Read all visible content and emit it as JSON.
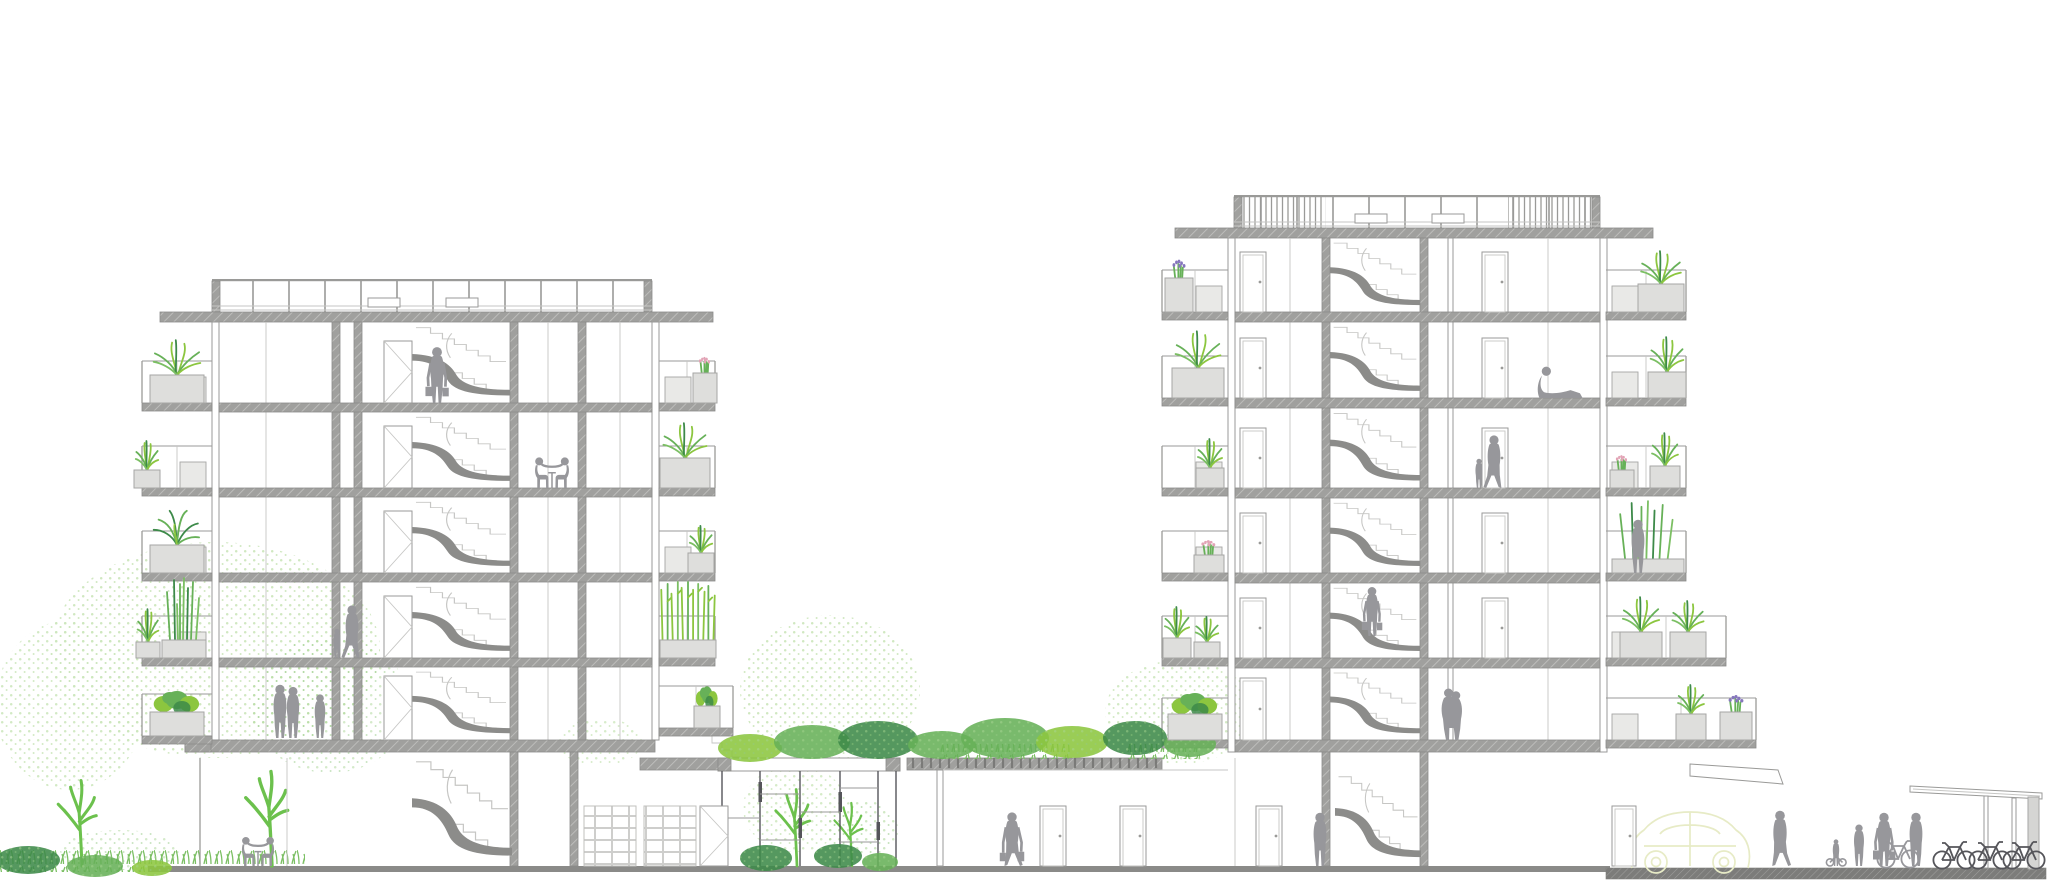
{
  "meta": {
    "drawing_type": "architectural cross-section",
    "subject": "two residential apartment blocks linked by a green-roofed podium with glazed atrium",
    "text_labels": []
  },
  "colors": {
    "background": "#ffffff",
    "slab": "#a0a09e",
    "slab_edge": "#8b8b89",
    "slab_solid": "#8c8c8a",
    "line": "#9a9a98",
    "line_light": "#c6c6c4",
    "glass": "#55555a",
    "people": "#97979b",
    "planter_fill": "#dededc",
    "planter_edge": "#a6a6a4",
    "screen_fill": "#e9e9e7",
    "green_bright": "#8cc63f",
    "green_mid": "#67b158",
    "green_dark": "#3d8a49",
    "green_pale": "#cde7bd",
    "green_line": "#6cc14d",
    "grass_stroke": "#7bbf63",
    "flower_pink": "#e2a4b6",
    "flower_purple": "#8677bd",
    "car_outline": "#e7ebc6",
    "ground": "#8a8a88",
    "sidewalk": "#7c7c7a",
    "trellis": "#70706e"
  },
  "scene": {
    "left_building": {
      "residential_floors": 5,
      "ground_floor": true,
      "roof_railing": true,
      "stair_core": true
    },
    "right_building": {
      "residential_floors": 6,
      "ground_floor": true,
      "roof_railing": true,
      "stair_core": true
    },
    "podium": {
      "glazed_atrium": true,
      "green_roof": true,
      "pergola_deck": true
    },
    "balconies": [
      {
        "x1": 142,
        "x2": 212,
        "y": 403,
        "scr": true
      },
      {
        "x1": 142,
        "x2": 212,
        "y": 488,
        "scr": true
      },
      {
        "x1": 142,
        "x2": 212,
        "y": 573,
        "scr": true
      },
      {
        "x1": 142,
        "x2": 212,
        "y": 658,
        "scr": true
      },
      {
        "x1": 142,
        "x2": 212,
        "y": 736,
        "scr": false
      },
      {
        "x1": 715,
        "x2": 659,
        "y": 403,
        "scr": true
      },
      {
        "x1": 715,
        "x2": 659,
        "y": 488,
        "scr": true
      },
      {
        "x1": 715,
        "x2": 659,
        "y": 573,
        "scr": true
      },
      {
        "x1": 715,
        "x2": 659,
        "y": 658,
        "scr": false
      },
      {
        "x1": 733,
        "x2": 659,
        "y": 728,
        "scr": false
      },
      {
        "x1": 1162,
        "x2": 1228,
        "y": 312,
        "scr": true
      },
      {
        "x1": 1162,
        "x2": 1228,
        "y": 398,
        "scr": true
      },
      {
        "x1": 1162,
        "x2": 1228,
        "y": 488,
        "scr": true
      },
      {
        "x1": 1162,
        "x2": 1228,
        "y": 573,
        "scr": true
      },
      {
        "x1": 1162,
        "x2": 1228,
        "y": 658,
        "scr": false
      },
      {
        "x1": 1162,
        "x2": 1228,
        "y": 740,
        "scr": false
      },
      {
        "x1": 1686,
        "x2": 1606,
        "y": 312,
        "scr": true
      },
      {
        "x1": 1686,
        "x2": 1606,
        "y": 398,
        "scr": true
      },
      {
        "x1": 1686,
        "x2": 1606,
        "y": 488,
        "scr": true
      },
      {
        "x1": 1686,
        "x2": 1606,
        "y": 573,
        "scr": false
      },
      {
        "x1": 1726,
        "x2": 1606,
        "y": 658,
        "scr": true
      },
      {
        "x1": 1756,
        "x2": 1606,
        "y": 740,
        "scr": true
      }
    ],
    "planters": [
      {
        "x": 150,
        "y": 403,
        "w": 54,
        "h": 28,
        "plant": "grass",
        "ph": 36
      },
      {
        "x": 134,
        "y": 488,
        "w": 26,
        "h": 18,
        "plant": "grass",
        "ph": 30
      },
      {
        "x": 150,
        "y": 573,
        "w": 54,
        "h": 28,
        "plant": "fern",
        "ph": 38
      },
      {
        "x": 136,
        "y": 658,
        "w": 24,
        "h": 16,
        "plant": "grass",
        "ph": 34
      },
      {
        "x": 162,
        "y": 658,
        "w": 44,
        "h": 18,
        "plant": "reeds",
        "ph": 60
      },
      {
        "x": 150,
        "y": 736,
        "w": 54,
        "h": 24,
        "plant": "shrub",
        "ph": 30
      },
      {
        "x": 693,
        "y": 403,
        "w": 24,
        "h": 30,
        "plant": "fpink",
        "ph": 24
      },
      {
        "x": 660,
        "y": 488,
        "w": 50,
        "h": 30,
        "plant": "grass",
        "ph": 36
      },
      {
        "x": 688,
        "y": 573,
        "w": 26,
        "h": 20,
        "plant": "grass",
        "ph": 28
      },
      {
        "x": 660,
        "y": 658,
        "w": 56,
        "h": 18,
        "plant": "bamboo",
        "ph": 58
      },
      {
        "x": 694,
        "y": 728,
        "w": 26,
        "h": 22,
        "plant": "shrub",
        "ph": 28
      },
      {
        "x": 1165,
        "y": 312,
        "w": 28,
        "h": 34,
        "plant": "fpurple",
        "ph": 26
      },
      {
        "x": 1172,
        "y": 398,
        "w": 52,
        "h": 30,
        "plant": "grass",
        "ph": 38
      },
      {
        "x": 1196,
        "y": 488,
        "w": 28,
        "h": 20,
        "plant": "grass",
        "ph": 30
      },
      {
        "x": 1194,
        "y": 573,
        "w": 30,
        "h": 18,
        "plant": "fpink",
        "ph": 22
      },
      {
        "x": 1163,
        "y": 658,
        "w": 28,
        "h": 20,
        "plant": "grass",
        "ph": 32
      },
      {
        "x": 1194,
        "y": 658,
        "w": 26,
        "h": 16,
        "plant": "grass",
        "ph": 26
      },
      {
        "x": 1168,
        "y": 740,
        "w": 54,
        "h": 26,
        "plant": "shrub",
        "ph": 30
      },
      {
        "x": 1638,
        "y": 312,
        "w": 46,
        "h": 28,
        "plant": "grass",
        "ph": 34
      },
      {
        "x": 1648,
        "y": 398,
        "w": 38,
        "h": 26,
        "plant": "grass",
        "ph": 36
      },
      {
        "x": 1610,
        "y": 488,
        "w": 24,
        "h": 18,
        "plant": "fpink",
        "ph": 22
      },
      {
        "x": 1650,
        "y": 488,
        "w": 30,
        "h": 22,
        "plant": "grass",
        "ph": 34
      },
      {
        "x": 1612,
        "y": 573,
        "w": 72,
        "h": 14,
        "plant": "reeds",
        "ph": 56
      },
      {
        "x": 1620,
        "y": 658,
        "w": 42,
        "h": 26,
        "plant": "grass",
        "ph": 36
      },
      {
        "x": 1670,
        "y": 658,
        "w": 36,
        "h": 26,
        "plant": "grass",
        "ph": 32
      },
      {
        "x": 1676,
        "y": 740,
        "w": 30,
        "h": 26,
        "plant": "grass",
        "ph": 30
      },
      {
        "x": 1720,
        "y": 740,
        "w": 32,
        "h": 28,
        "plant": "fpurple",
        "ph": 24
      }
    ],
    "doors": [
      {
        "x": 384,
        "y": 403,
        "w": 28,
        "h": 62,
        "t": "x"
      },
      {
        "x": 384,
        "y": 488,
        "w": 28,
        "h": 62,
        "t": "x"
      },
      {
        "x": 384,
        "y": 573,
        "w": 28,
        "h": 62,
        "t": "x"
      },
      {
        "x": 384,
        "y": 658,
        "w": 28,
        "h": 62,
        "t": "x"
      },
      {
        "x": 384,
        "y": 740,
        "w": 28,
        "h": 64,
        "t": "x"
      },
      {
        "x": 700,
        "y": 866,
        "w": 28,
        "h": 60,
        "t": "x"
      },
      {
        "x": 1240,
        "y": 312,
        "w": 26,
        "h": 60,
        "t": "p"
      },
      {
        "x": 1240,
        "y": 398,
        "w": 26,
        "h": 60,
        "t": "p"
      },
      {
        "x": 1240,
        "y": 488,
        "w": 26,
        "h": 60,
        "t": "p"
      },
      {
        "x": 1240,
        "y": 573,
        "w": 26,
        "h": 60,
        "t": "p"
      },
      {
        "x": 1240,
        "y": 658,
        "w": 26,
        "h": 60,
        "t": "p"
      },
      {
        "x": 1240,
        "y": 740,
        "w": 26,
        "h": 62,
        "t": "p"
      },
      {
        "x": 1482,
        "y": 312,
        "w": 26,
        "h": 60,
        "t": "p"
      },
      {
        "x": 1482,
        "y": 398,
        "w": 26,
        "h": 60,
        "t": "p"
      },
      {
        "x": 1482,
        "y": 488,
        "w": 26,
        "h": 60,
        "t": "p"
      },
      {
        "x": 1482,
        "y": 573,
        "w": 26,
        "h": 60,
        "t": "p"
      },
      {
        "x": 1482,
        "y": 658,
        "w": 26,
        "h": 60,
        "t": "p"
      },
      {
        "x": 1040,
        "y": 866,
        "w": 26,
        "h": 60,
        "t": "p"
      },
      {
        "x": 1120,
        "y": 866,
        "w": 26,
        "h": 60,
        "t": "p"
      },
      {
        "x": 1256,
        "y": 866,
        "w": 26,
        "h": 60,
        "t": "p"
      },
      {
        "x": 1612,
        "y": 866,
        "w": 24,
        "h": 60,
        "t": "p"
      }
    ],
    "stairs": [
      {
        "x": 412,
        "y": 322,
        "w": 98,
        "h": 81
      },
      {
        "x": 412,
        "y": 412,
        "w": 98,
        "h": 76
      },
      {
        "x": 412,
        "y": 497,
        "w": 98,
        "h": 76
      },
      {
        "x": 412,
        "y": 582,
        "w": 98,
        "h": 76
      },
      {
        "x": 412,
        "y": 667,
        "w": 98,
        "h": 73
      },
      {
        "x": 412,
        "y": 754,
        "w": 100,
        "h": 112
      },
      {
        "x": 1330,
        "y": 238,
        "w": 90,
        "h": 74
      },
      {
        "x": 1330,
        "y": 322,
        "w": 90,
        "h": 76
      },
      {
        "x": 1330,
        "y": 408,
        "w": 90,
        "h": 80
      },
      {
        "x": 1330,
        "y": 498,
        "w": 90,
        "h": 75
      },
      {
        "x": 1330,
        "y": 583,
        "w": 90,
        "h": 75
      },
      {
        "x": 1330,
        "y": 668,
        "w": 90,
        "h": 72
      },
      {
        "x": 1335,
        "y": 770,
        "w": 86,
        "h": 96
      }
    ],
    "people": [
      {
        "name": "person-with-bags-stair-landing",
        "t": "stand-bags",
        "x": 437,
        "y": 403,
        "s": 1.05
      },
      {
        "name": "two-people-at-table-floor4",
        "t": "table-pair",
        "x": 552,
        "y": 488,
        "s": 0.95
      },
      {
        "name": "parent-and-child-walking-floor2",
        "t": "adult-child",
        "x": 352,
        "y": 658,
        "s": 1
      },
      {
        "name": "couple-standing-floor1",
        "t": "pair-stand",
        "x": 286,
        "y": 738,
        "s": 1
      },
      {
        "name": "teen-standing-floor1",
        "t": "stand",
        "x": 320,
        "y": 738,
        "s": 0.82
      },
      {
        "name": "two-people-at-table-ground",
        "t": "table-pair",
        "x": 258,
        "y": 866,
        "s": 0.9
      },
      {
        "name": "person-reclining-floor5",
        "t": "lounge",
        "x": 1560,
        "y": 398,
        "s": 1.05
      },
      {
        "name": "parent-and-child-floor4",
        "t": "adult-child",
        "x": 1494,
        "y": 488,
        "s": 1
      },
      {
        "name": "person-on-planted-balcony",
        "t": "stand",
        "x": 1638,
        "y": 573,
        "s": 1
      },
      {
        "name": "person-descending-stairs",
        "t": "stand-bags",
        "x": 1372,
        "y": 636,
        "s": 0.92
      },
      {
        "name": "couple-embracing-floor1",
        "t": "pair-hug",
        "x": 1452,
        "y": 740,
        "s": 1
      },
      {
        "name": "person-walking-with-bags-hall",
        "t": "walk-bags",
        "x": 1012,
        "y": 866,
        "s": 1.02,
        "flip": true
      },
      {
        "name": "person-standing-ground-floor",
        "t": "stand",
        "x": 1320,
        "y": 866,
        "s": 1
      },
      {
        "name": "person-walking-street",
        "t": "walk",
        "x": 1780,
        "y": 866,
        "s": 1.05,
        "flip": true
      },
      {
        "name": "child-on-balance-bike",
        "t": "child-bike",
        "x": 1836,
        "y": 866,
        "s": 1
      },
      {
        "name": "teen-standing-street",
        "t": "stand",
        "x": 1859,
        "y": 866,
        "s": 0.78
      },
      {
        "name": "adult-with-bag-street",
        "t": "stand-bags",
        "x": 1884,
        "y": 866,
        "s": 1
      },
      {
        "name": "person-holding-bicycle",
        "t": "stand",
        "x": 1916,
        "y": 866,
        "s": 1
      }
    ],
    "bicycles": [
      {
        "x": 1898,
        "y": 868,
        "s": 1,
        "dark": false
      },
      {
        "x": 1954,
        "y": 869,
        "s": 1,
        "dark": true
      },
      {
        "x": 1990,
        "y": 869,
        "s": 1,
        "dark": true
      },
      {
        "x": 2024,
        "y": 869,
        "s": 1,
        "dark": true
      }
    ],
    "trees": [
      {
        "x": 82,
        "y": 866,
        "s": 0.95
      },
      {
        "x": 272,
        "y": 866,
        "s": 1.05
      },
      {
        "x": 797,
        "y": 866,
        "s": 0.85
      },
      {
        "x": 852,
        "y": 866,
        "s": 0.7
      }
    ],
    "foliage": [
      {
        "cx": 215,
        "cy": 650,
        "rx": 165,
        "ry": 108,
        "tone": "pale",
        "op": 0.95
      },
      {
        "cx": 70,
        "cy": 705,
        "rx": 75,
        "ry": 85,
        "tone": "pale",
        "op": 0.9
      },
      {
        "cx": 330,
        "cy": 705,
        "rx": 80,
        "ry": 68,
        "tone": "mid",
        "op": 0.5
      },
      {
        "cx": 830,
        "cy": 690,
        "rx": 90,
        "ry": 75,
        "tone": "pale",
        "op": 0.95
      },
      {
        "cx": 1180,
        "cy": 712,
        "rx": 75,
        "ry": 52,
        "tone": "pale",
        "op": 0.9
      },
      {
        "cx": 600,
        "cy": 742,
        "rx": 42,
        "ry": 24,
        "tone": "pale",
        "op": 0.8
      },
      {
        "cx": 795,
        "cy": 808,
        "rx": 52,
        "ry": 44,
        "tone": "pale",
        "op": 0.85
      },
      {
        "cx": 862,
        "cy": 830,
        "rx": 36,
        "ry": 30,
        "tone": "mid",
        "op": 0.55
      },
      {
        "cx": 120,
        "cy": 850,
        "rx": 60,
        "ry": 20,
        "tone": "mid",
        "op": 0.5
      }
    ],
    "shrubs": [
      {
        "cx": 750,
        "cy": 748,
        "rx": 32,
        "ry": 14,
        "tone": "bright"
      },
      {
        "cx": 812,
        "cy": 742,
        "rx": 38,
        "ry": 17,
        "tone": "mid"
      },
      {
        "cx": 878,
        "cy": 740,
        "rx": 40,
        "ry": 19,
        "tone": "dark"
      },
      {
        "cx": 942,
        "cy": 745,
        "rx": 34,
        "ry": 14,
        "tone": "mid"
      },
      {
        "cx": 1005,
        "cy": 738,
        "rx": 44,
        "ry": 20,
        "tone": "mid"
      },
      {
        "cx": 1072,
        "cy": 742,
        "rx": 36,
        "ry": 16,
        "tone": "bright"
      },
      {
        "cx": 1135,
        "cy": 738,
        "rx": 32,
        "ry": 17,
        "tone": "dark"
      },
      {
        "cx": 1190,
        "cy": 744,
        "rx": 26,
        "ry": 13,
        "tone": "mid"
      },
      {
        "cx": 766,
        "cy": 858,
        "rx": 26,
        "ry": 13,
        "tone": "dark"
      },
      {
        "cx": 838,
        "cy": 856,
        "rx": 24,
        "ry": 12,
        "tone": "dark"
      },
      {
        "cx": 880,
        "cy": 862,
        "rx": 18,
        "ry": 9,
        "tone": "mid"
      },
      {
        "cx": 28,
        "cy": 860,
        "rx": 32,
        "ry": 14,
        "tone": "dark"
      },
      {
        "cx": 95,
        "cy": 866,
        "rx": 28,
        "ry": 11,
        "tone": "mid"
      },
      {
        "cx": 152,
        "cy": 868,
        "rx": 20,
        "ry": 8,
        "tone": "bright"
      }
    ]
  }
}
